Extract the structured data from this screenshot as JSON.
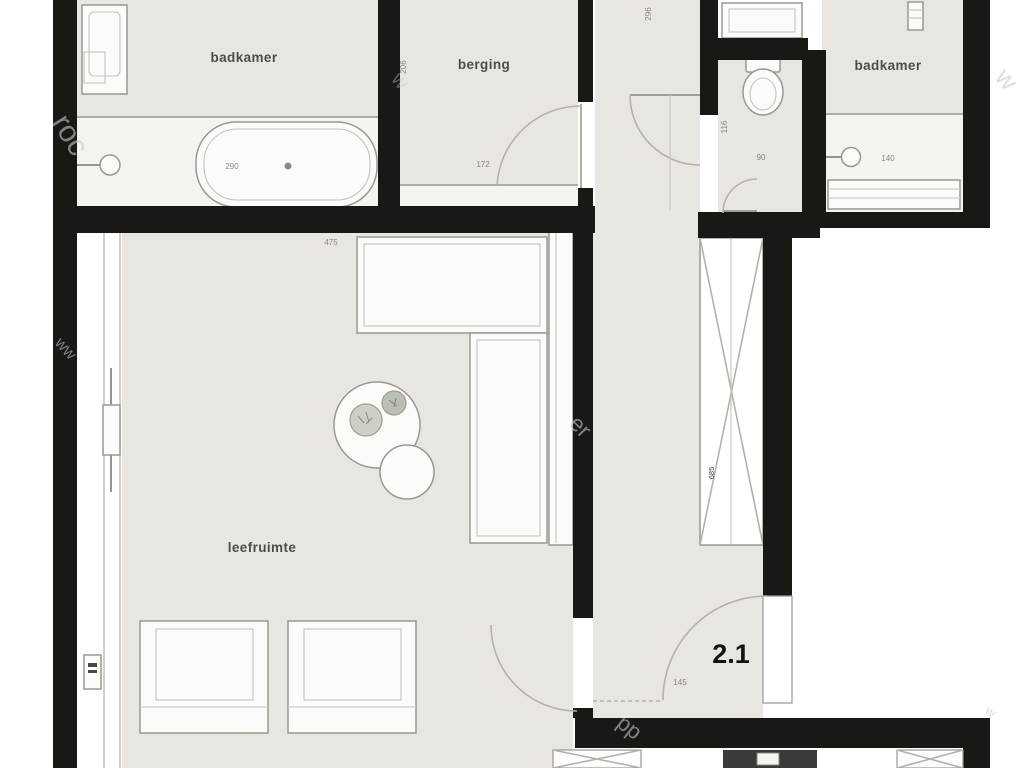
{
  "plan": {
    "unit": {
      "number": "2.1",
      "entry_door_dim": "145"
    },
    "rooms": {
      "badkamer_left": {
        "label": "badkamer",
        "bathtub_dim": "290"
      },
      "berging": {
        "label": "berging",
        "door_dim": "172",
        "wall_dim": "206"
      },
      "hallway": {
        "top_dim": "296",
        "shaft_dim": "685"
      },
      "wc": {
        "depth_dim": "116",
        "width_dim": "90"
      },
      "badkamer_right": {
        "label": "badkamer",
        "basin_dim": "140"
      },
      "leefruimte": {
        "label": "leefruimte",
        "kitchen_dim": "475"
      }
    },
    "watermark": {
      "top_left": "roc",
      "top_mid": "w",
      "top_right": "w",
      "mid": "er",
      "left_mid": "ww",
      "bottom": "pp",
      "bottom_right": "w"
    },
    "colors": {
      "wall": "#191814",
      "floor": "#e9e6e1",
      "wet_floor": "#f4f3ee",
      "fixture_stroke": "#9b978f",
      "arc": "#b5b1aa",
      "dim_text": "#8a867e",
      "label_text": "#34322e",
      "watermark": "#c7c7c7",
      "lift": "#3b3a37"
    }
  }
}
